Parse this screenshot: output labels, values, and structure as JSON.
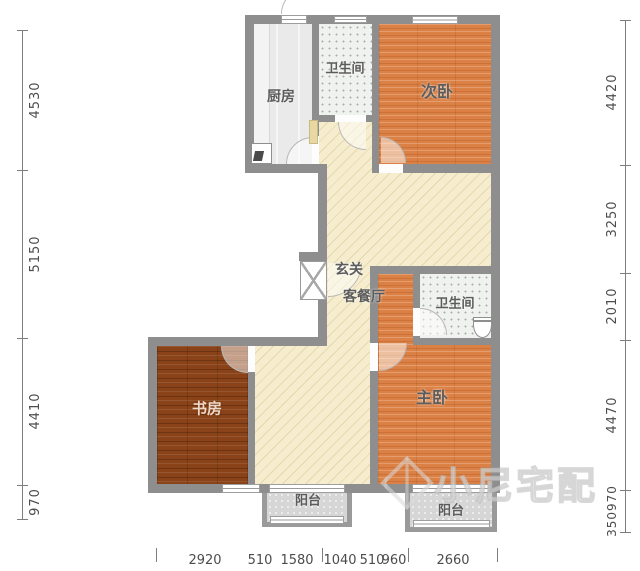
{
  "plan_title": "三室两卫户型图",
  "rooms": {
    "kitchen": "厨房",
    "bath_top": "卫生间",
    "bedroom2": "次卧",
    "entry": "玄关",
    "living": "客餐厅",
    "bath_mid": "卫生间",
    "study": "书房",
    "master": "主卧",
    "balcony_left": "阳台",
    "balcony_right": "阳台"
  },
  "dimensions": {
    "left": [
      "4530",
      "5150",
      "4410",
      "970"
    ],
    "right": [
      "4420",
      "3250",
      "2010",
      "4470",
      "350970"
    ],
    "bottom": [
      "2920",
      "510",
      "1580",
      "1040",
      "510",
      "960",
      "2660"
    ]
  },
  "watermark": {
    "text": "小尼宅配"
  },
  "colors": {
    "wall": "#8e8e8e",
    "bedroom_floor": "#dc8145",
    "study_floor": "#8a4318",
    "hall_floor": "#f5edcd",
    "tile_floor": "#f0f2ef",
    "kitchen_floor": "#eaeaea",
    "balcony_floor": "#d6d6d6",
    "dimension_text": "#4c4c4c"
  }
}
